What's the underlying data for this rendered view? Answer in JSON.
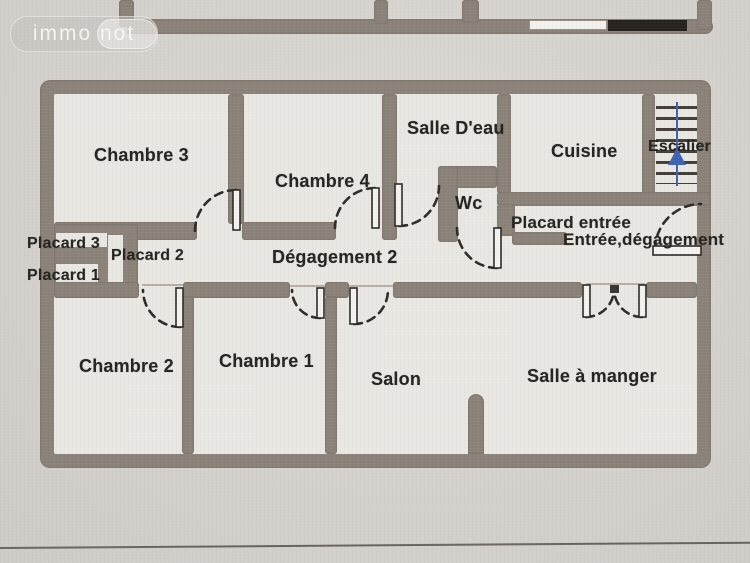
{
  "watermark": {
    "text": "immo not"
  },
  "floor_plan": {
    "rooms": {
      "chambre3": "Chambre 3",
      "chambre4": "Chambre 4",
      "salle_deau": "Salle D'eau",
      "wc": "Wc",
      "cuisine": "Cuisine",
      "escalier": "Escalier",
      "placard_entree": "Placard entrée",
      "entree_degagement": "Entrée,dégagement",
      "placard3": "Placard 3",
      "placard2": "Placard 2",
      "placard1": "Placard 1",
      "degagement2": "Dégagement 2",
      "chambre2": "Chambre 2",
      "chambre1": "Chambre 1",
      "salon": "Salon",
      "salle_a_manger": "Salle à manger"
    },
    "stairs_direction": "up",
    "colors": {
      "wall": "#8b8279",
      "room_fill": "#e9e7e2",
      "paper": "#d8d5d0",
      "text": "#262420",
      "stairs_arrow": "#3f63b4"
    }
  }
}
